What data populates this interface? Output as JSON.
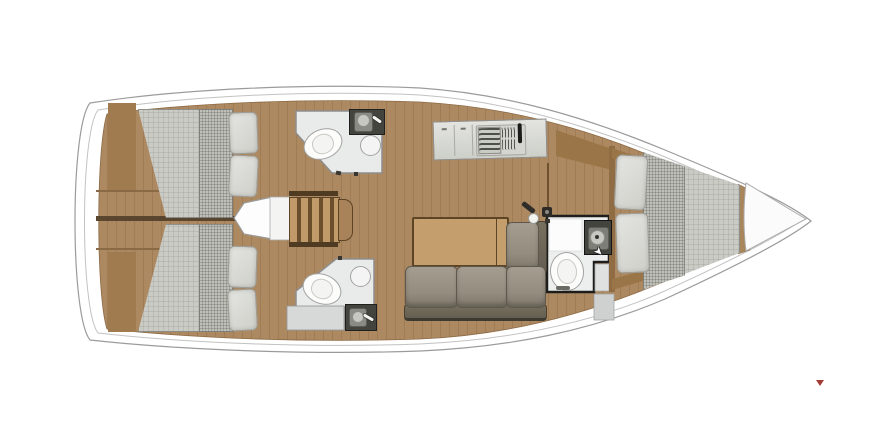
{
  "meta": {
    "title": "Sailing yacht interior floor plan, top view, bow pointing right",
    "type": "floor-plan"
  },
  "colors": {
    "canvas": "#ffffff",
    "hull-line": "#9b9b9b",
    "deck-line": "#c2c2c2",
    "floor-wood": "#ad8961",
    "floor-grain": "#8c6a45",
    "wood-wall": "#a17b50",
    "wood-band": "#9a7548",
    "wall-dark": "#5a452e",
    "step-line": "#8a6a45",
    "mattress": "#cbcbc5",
    "mattress-band": "#c0c0ba",
    "pillow-a": "#e4e4e0",
    "pillow-b": "#cfcfca",
    "bath-floor": "#e9ebea",
    "bath-wall": "#8e8e8e",
    "head-outline": "#1d1d1b",
    "bath-tray": "#d7d9d8",
    "counter-a": "#e3e4e0",
    "counter-b": "#cdcfc9",
    "counter-line": "#8f8f8f",
    "sofa-a": "#a59d8f",
    "sofa-b": "#7d7769",
    "sofa-edge": "#5e584c",
    "sofa-back-a": "#77705f",
    "sofa-back-b": "#645e52",
    "table": "#c59e6e",
    "table-edge": "#5d4425",
    "stair-light": "#c09a68",
    "stair-dark": "#6b4e2c",
    "fixture-dark": "#44443f",
    "basin": "#8b8b85",
    "basin-circle": "#c8c8c2",
    "white-box": "#f4f4f2",
    "marker-red": "#a33c36"
  },
  "layout": {
    "bow_direction": "right",
    "rooms": [
      {
        "id": "aft-cabin-port",
        "furniture": [
          "double-berth",
          "pillow",
          "pillow"
        ]
      },
      {
        "id": "aft-cabin-starboard",
        "furniture": [
          "double-berth",
          "pillow",
          "pillow"
        ]
      },
      {
        "id": "head-aft-port",
        "furniture": [
          "toilet",
          "shower",
          "sink"
        ]
      },
      {
        "id": "head-aft-starboard",
        "furniture": [
          "toilet",
          "shower",
          "sink"
        ]
      },
      {
        "id": "companionway",
        "furniture": [
          "stairs",
          "engine-box"
        ]
      },
      {
        "id": "galley",
        "furniture": [
          "counter",
          "stove",
          "sink",
          "faucet"
        ]
      },
      {
        "id": "salon",
        "furniture": [
          "folding-table",
          "l-shaped-sofa",
          "lamp",
          "mast-post"
        ]
      },
      {
        "id": "head-forward",
        "furniture": [
          "toilet",
          "sink"
        ]
      },
      {
        "id": "cabin-forward",
        "furniture": [
          "v-berth",
          "pillow",
          "pillow"
        ]
      },
      {
        "id": "bow-locker",
        "furniture": []
      }
    ],
    "marker": {
      "shape": "small-red-triangle",
      "position": "lower-right"
    }
  }
}
